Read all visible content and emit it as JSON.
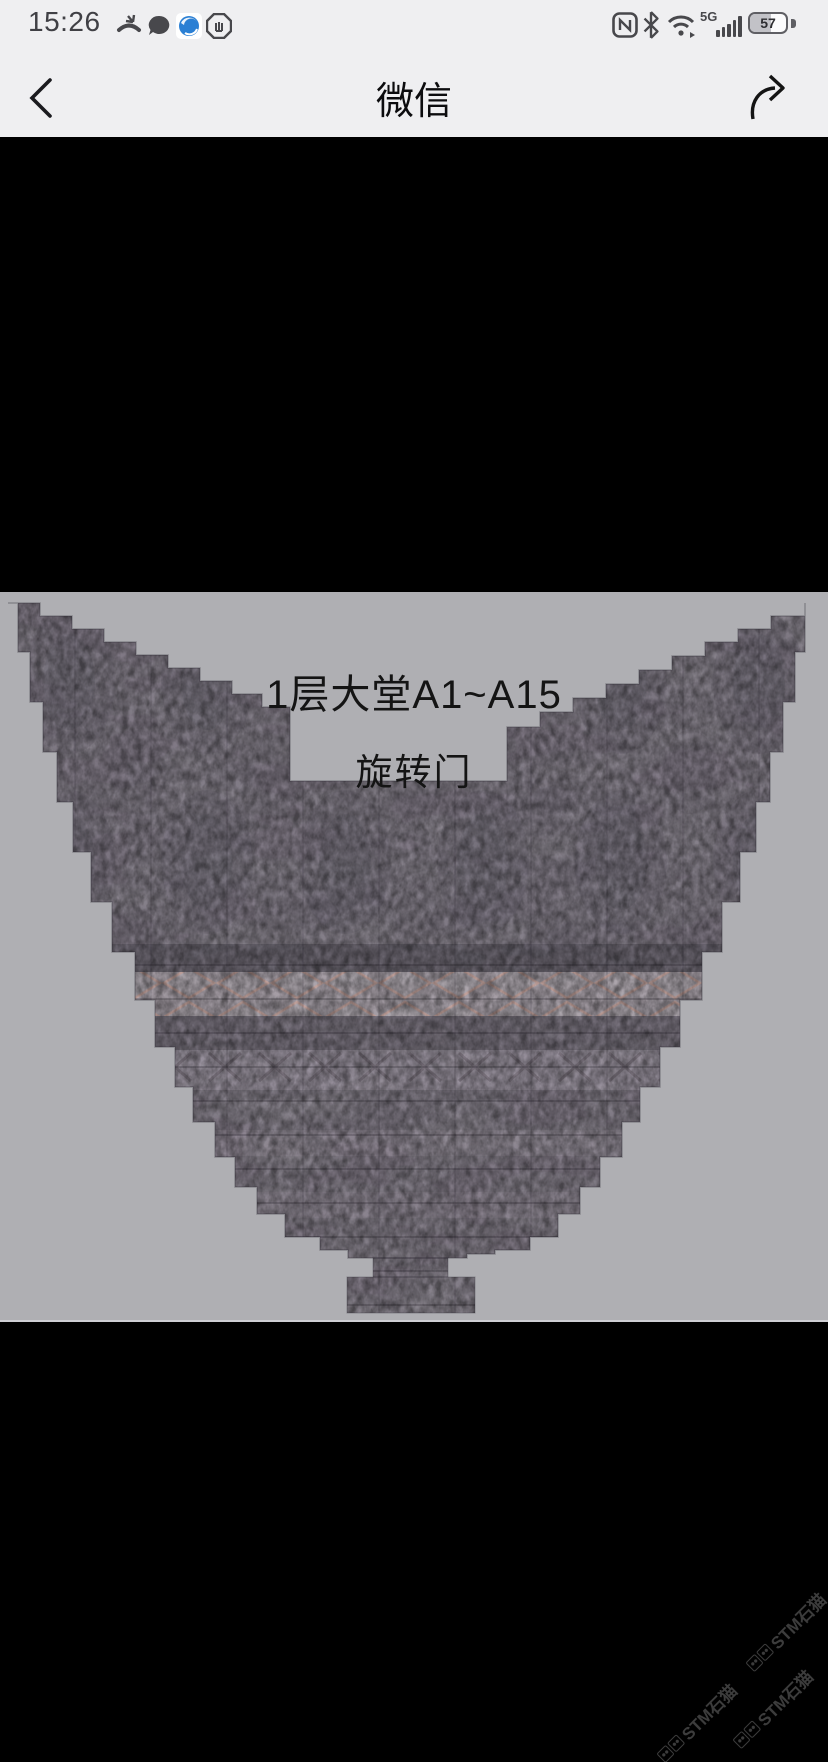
{
  "status_bar": {
    "time": "15:26",
    "network_label": "5G",
    "battery_percent": "57",
    "left_icon_names": [
      "missed-call-icon",
      "message-icon",
      "browser-app-icon",
      "hand-octagon-icon"
    ],
    "right_icon_names": [
      "nfc-icon",
      "bluetooth-icon",
      "wifi-icon",
      "signal-bars-icon",
      "battery-icon"
    ]
  },
  "nav_bar": {
    "title": "微信"
  },
  "photo": {
    "area_label": "1层大堂A1~A15",
    "door_label": "旋转门"
  },
  "watermark": {
    "text": "STM石猫",
    "count": 3
  },
  "colors": {
    "header_bg": "#efeff1",
    "status_text": "#404045",
    "photo_bg": "#afafb3",
    "stone_base": "#8a858e",
    "stone_dark_band": "#67636d",
    "stone_light_band": "#a8a1a8",
    "stone_accent": "#b59a96",
    "watermark_text": "#3c3c3c"
  }
}
